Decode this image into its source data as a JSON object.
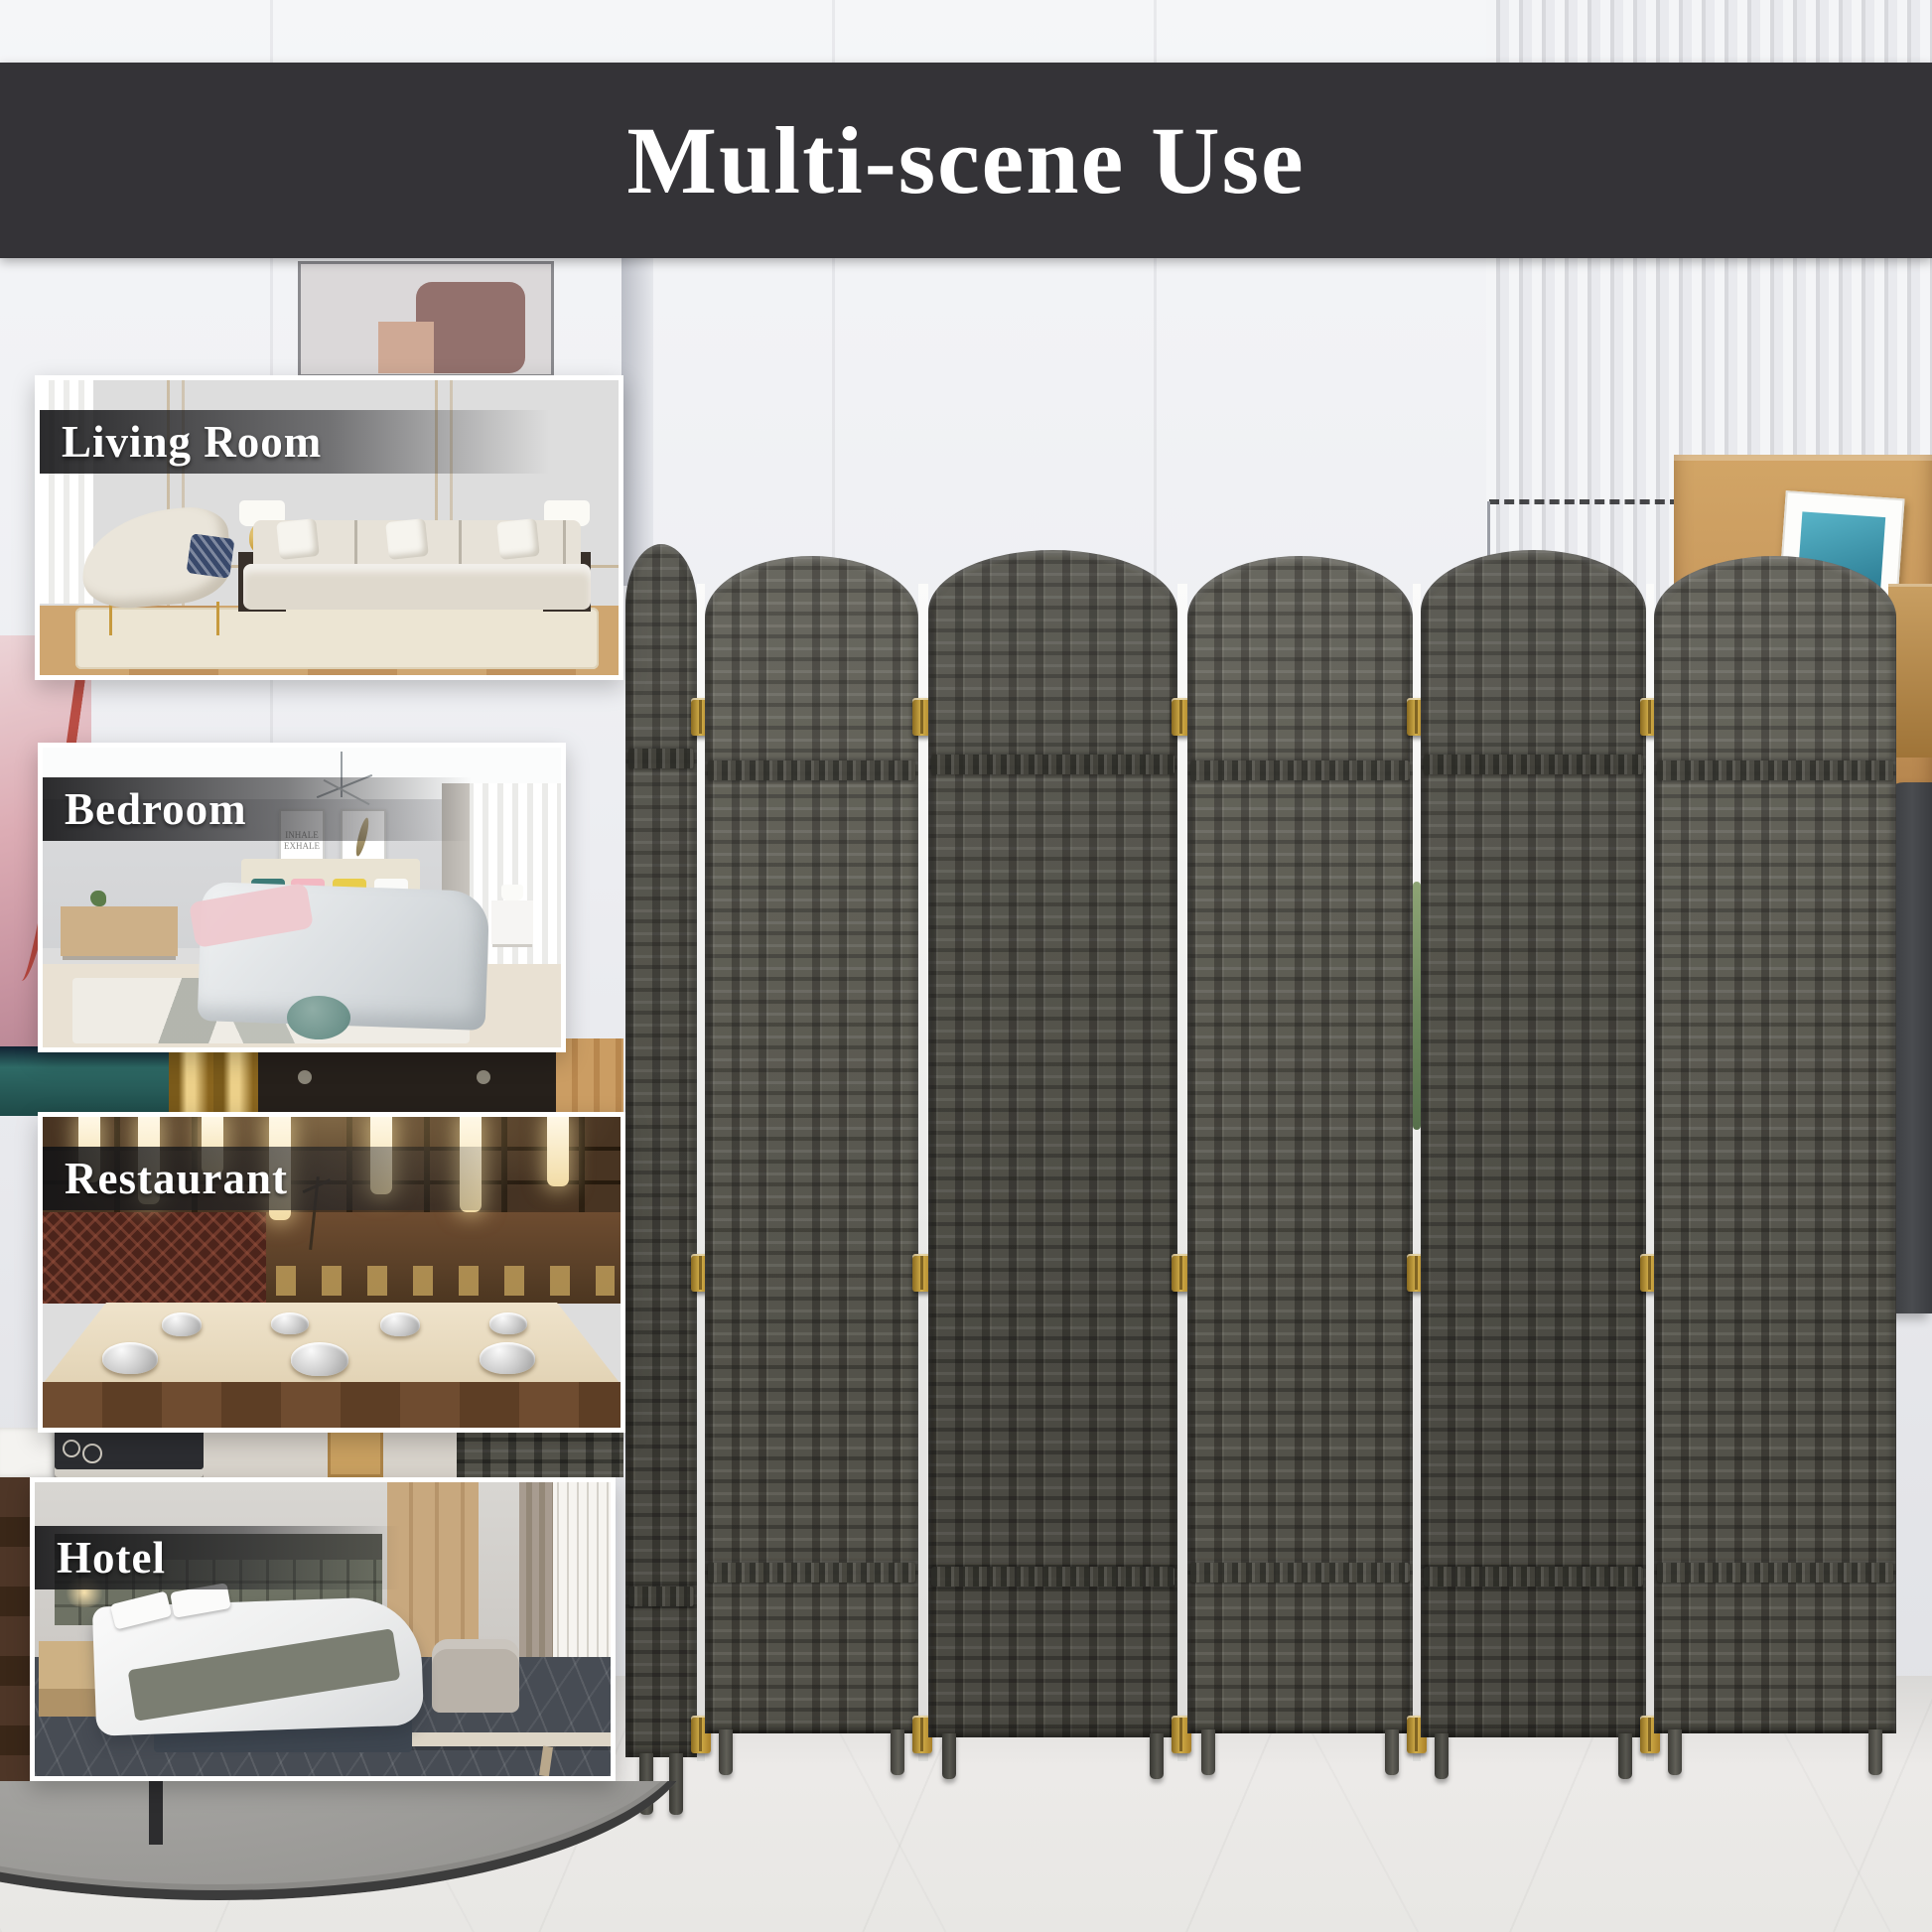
{
  "banner": {
    "title": "Multi-scene Use"
  },
  "scenes": [
    {
      "name": "living-room",
      "label": "Living Room"
    },
    {
      "name": "bedroom",
      "label": "Bedroom",
      "frame_text": "INHALE EXHALE"
    },
    {
      "name": "restaurant",
      "label": "Restaurant"
    },
    {
      "name": "hotel",
      "label": "Hotel"
    }
  ],
  "divider": {
    "panel_count": 6,
    "hinge_rows": 3
  },
  "colors": {
    "banner_bg": "#343337",
    "banner_text": "#ffffff",
    "divider_weave": "#59584f",
    "hinge_gold": "#d4b04a",
    "label_text": "#ffffff"
  }
}
